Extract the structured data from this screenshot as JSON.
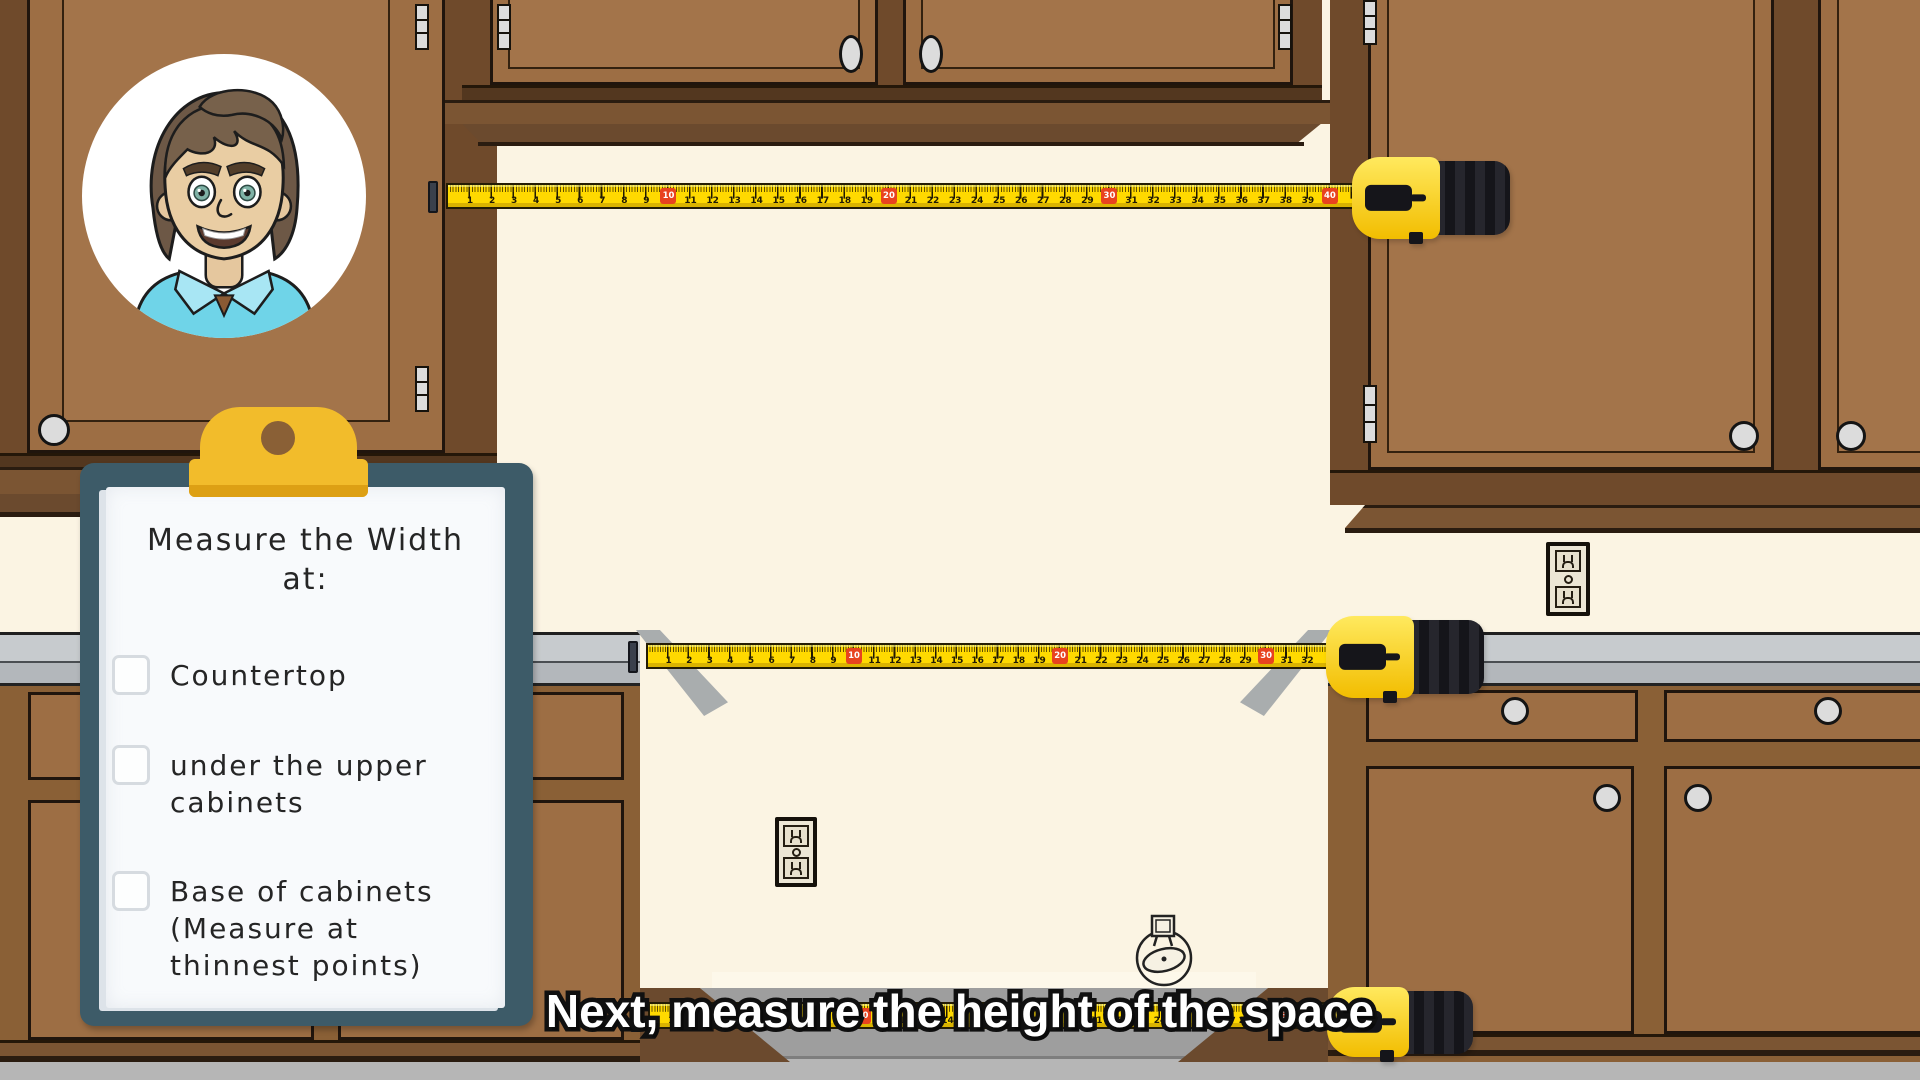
{
  "caption": {
    "text": "Next, measure the height of the space"
  },
  "clipboard": {
    "title_line1": "Measure the Width",
    "title_line2": "at:",
    "items": [
      {
        "label": "Countertop",
        "checked": false
      },
      {
        "label": "under the upper\ncabinets",
        "checked": false
      },
      {
        "label": "Base of cabinets\n(Measure at\nthinnest points)",
        "checked": false
      }
    ]
  },
  "tapes": [
    {
      "id": "upper-width",
      "units": 41,
      "red_interval": 10
    },
    {
      "id": "countertop-width",
      "units": 33,
      "red_interval": 10
    },
    {
      "id": "base-width",
      "units": 32,
      "red_interval": 10
    }
  ],
  "icons": {
    "doodle": "tape-measure-doodle",
    "avatar": "presenter-avatar",
    "outlet": "power-outlet"
  },
  "colors": {
    "wall": "#fbf4e3",
    "cabinet_frame": "#6f4a2b",
    "cabinet_door": "#9d6e44",
    "cabinet_panel": "#a3744a",
    "cabinet_rail": "#8a6036",
    "crown": "#7b5533",
    "outline": "#20150d",
    "countertop_light": "#c7cbce",
    "countertop_mid": "#b3b7bb",
    "floor": "#b6b6b6",
    "gap_shadow": "#9e9e9e",
    "tape_yellow": "#ffd900",
    "tape_red": "#e8431f",
    "case_black": "#1a1a20",
    "case_yellow": "#f2bd00",
    "clipboard_board": "#3d5b68",
    "clipboard_paper": "#f8fafc",
    "clip_yellow": "#f2bc2b",
    "hardware": "#dcdcdc",
    "shirt": "#6fd4e8",
    "skin": "#e9cda3",
    "hair": "#6d5846"
  }
}
